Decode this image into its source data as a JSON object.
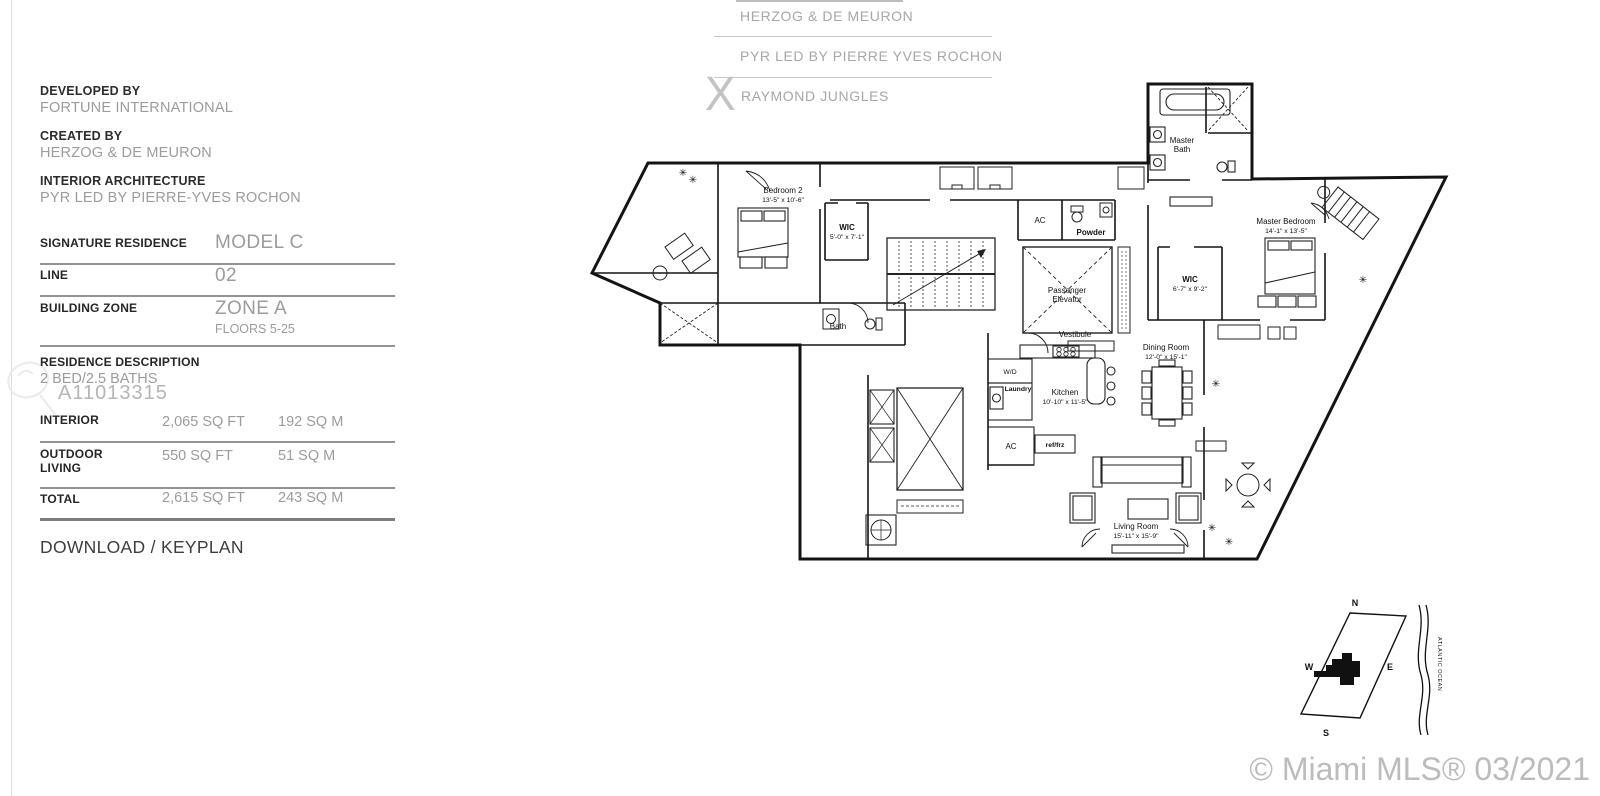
{
  "top_credits": {
    "lines": [
      "HERZOG & DE MEURON",
      "PYR LED BY PIERRE YVES ROCHON",
      "RAYMOND JUNGLES"
    ],
    "x_mark": "X"
  },
  "credits": [
    {
      "label": "DEVELOPED BY",
      "value": "FORTUNE INTERNATIONAL"
    },
    {
      "label": "CREATED BY",
      "value": "HERZOG & DE MEURON"
    },
    {
      "label": "INTERIOR ARCHITECTURE",
      "value": "PYR LED BY PIERRE-YVES ROCHON"
    }
  ],
  "spec": {
    "rows": [
      {
        "label": "SIGNATURE RESIDENCE",
        "value": "MODEL C"
      },
      {
        "label": "LINE",
        "value": "02"
      },
      {
        "label": "BUILDING ZONE",
        "value": "ZONE A",
        "sub": "FLOORS 5-25"
      }
    ],
    "description_label": "RESIDENCE DESCRIPTION",
    "description_value": "2 BED/2.5 BATHS",
    "mls_id": "A11013315",
    "areas": [
      {
        "label": "INTERIOR",
        "label2": "",
        "sqft": "2,065 SQ FT",
        "sqm": "192 SQ M"
      },
      {
        "label": "OUTDOOR",
        "label2": "LIVING",
        "sqft": "550 SQ FT",
        "sqm": "51 SQ M"
      },
      {
        "label": "TOTAL",
        "label2": "",
        "sqft": "2,615 SQ FT",
        "sqm": "243 SQ M"
      }
    ]
  },
  "download": {
    "left": "DOWNLOAD",
    "sep": " / ",
    "right": "KEYPLAN"
  },
  "floorplan": {
    "plant_icon": "✳",
    "rooms": [
      {
        "lines": [
          "Bedroom 2",
          "13'-5\" x 10'-6\""
        ]
      },
      {
        "lines": [
          "WIC",
          "5'-0\" x 7'-1\""
        ]
      },
      {
        "lines": [
          "Bath"
        ]
      },
      {
        "lines": [
          "Master",
          "Bath"
        ]
      },
      {
        "lines": [
          "Master Bedroom",
          "14'-1\" x 13'-5\""
        ]
      },
      {
        "lines": [
          "WIC",
          "6'-7\" x 9'-2\""
        ]
      },
      {
        "lines": [
          "AC"
        ]
      },
      {
        "lines": [
          "Powder"
        ]
      },
      {
        "lines": [
          "Passenger",
          "Elevator"
        ]
      },
      {
        "lines": [
          "Vestibule"
        ]
      },
      {
        "lines": [
          "Dining Room",
          "12'-0\" x 15'-1\""
        ]
      },
      {
        "lines": [
          "Kitchen",
          "10'-10\" x 11'-5\""
        ]
      },
      {
        "lines": [
          "W/D"
        ]
      },
      {
        "lines": [
          "Laundry"
        ]
      },
      {
        "lines": [
          "AC"
        ]
      },
      {
        "lines": [
          "ref/frz"
        ]
      },
      {
        "lines": [
          "Living Room",
          "15'-11\" x 15'-9\""
        ]
      }
    ]
  },
  "keyplan": {
    "north": "N",
    "south": "S",
    "east": "E",
    "west": "W",
    "ocean": "ATLANTIC OCEAN"
  },
  "footer": {
    "copyright": "© Miami MLS® 03/2021"
  }
}
